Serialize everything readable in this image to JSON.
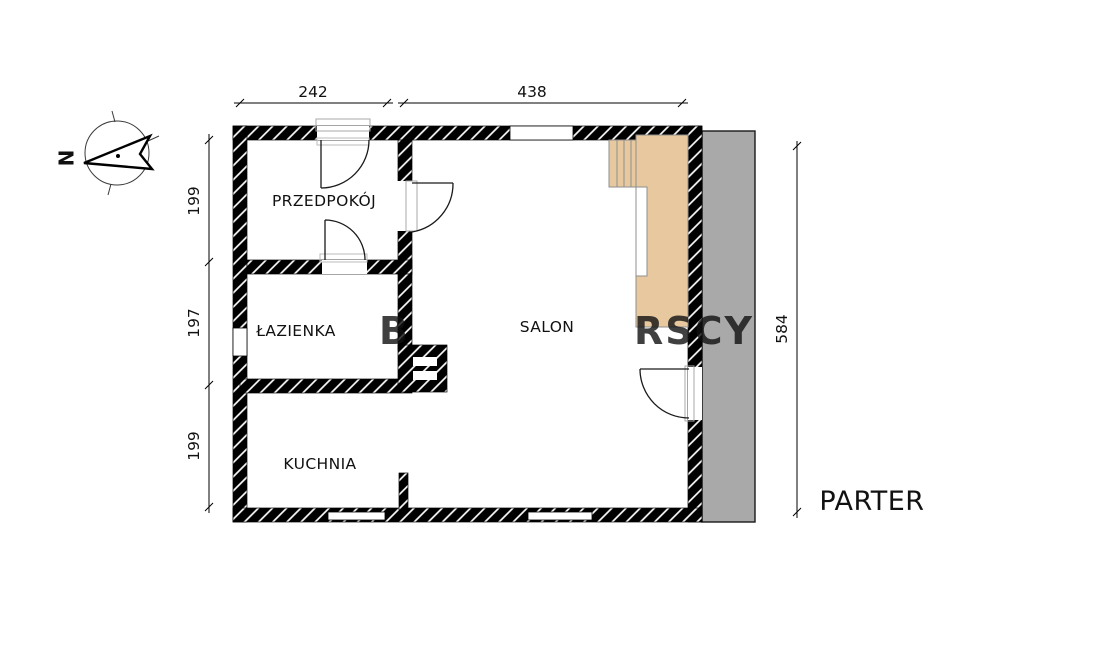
{
  "plan": {
    "title": "PARTER",
    "rooms": {
      "hallway": "PRZEDPOKÓJ",
      "bathroom": "ŁAZIENKA",
      "kitchen": "KUCHNIA",
      "living_room": "SALON"
    },
    "dimensions_cm": {
      "top": [
        "242",
        "438"
      ],
      "left": [
        "199",
        "197",
        "199"
      ],
      "right": [
        "584"
      ]
    },
    "compass": {
      "north_label": "N"
    },
    "watermark": {
      "left_fragment": "B",
      "right_fragment": "RSCY"
    },
    "colors": {
      "wall": "#000000",
      "stairs_fill": "#e8c89e",
      "stairs_stroke": "#8f8f8f",
      "terrace_fill": "#a9a9a9",
      "watermark": "#ffffff"
    }
  }
}
